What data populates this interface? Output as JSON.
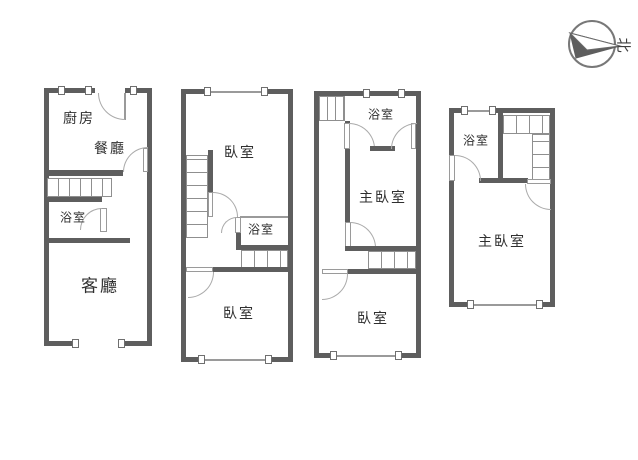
{
  "colors": {
    "wall": "#5e5e5e",
    "thin_line": "#9a9a9a",
    "text": "#2f2f2f"
  },
  "compass": {
    "north_label": "北"
  },
  "floors": [
    {
      "rooms": [
        {
          "label": "廚房"
        },
        {
          "label": "餐廳"
        },
        {
          "label": "浴室"
        },
        {
          "label": "客廳"
        }
      ]
    },
    {
      "rooms": [
        {
          "label": "臥室"
        },
        {
          "label": "浴室"
        },
        {
          "label": "臥室"
        }
      ]
    },
    {
      "rooms": [
        {
          "label": "浴室"
        },
        {
          "label": "主臥室"
        },
        {
          "label": "臥室"
        }
      ]
    },
    {
      "rooms": [
        {
          "label": "浴室"
        },
        {
          "label": "主臥室"
        }
      ]
    }
  ]
}
